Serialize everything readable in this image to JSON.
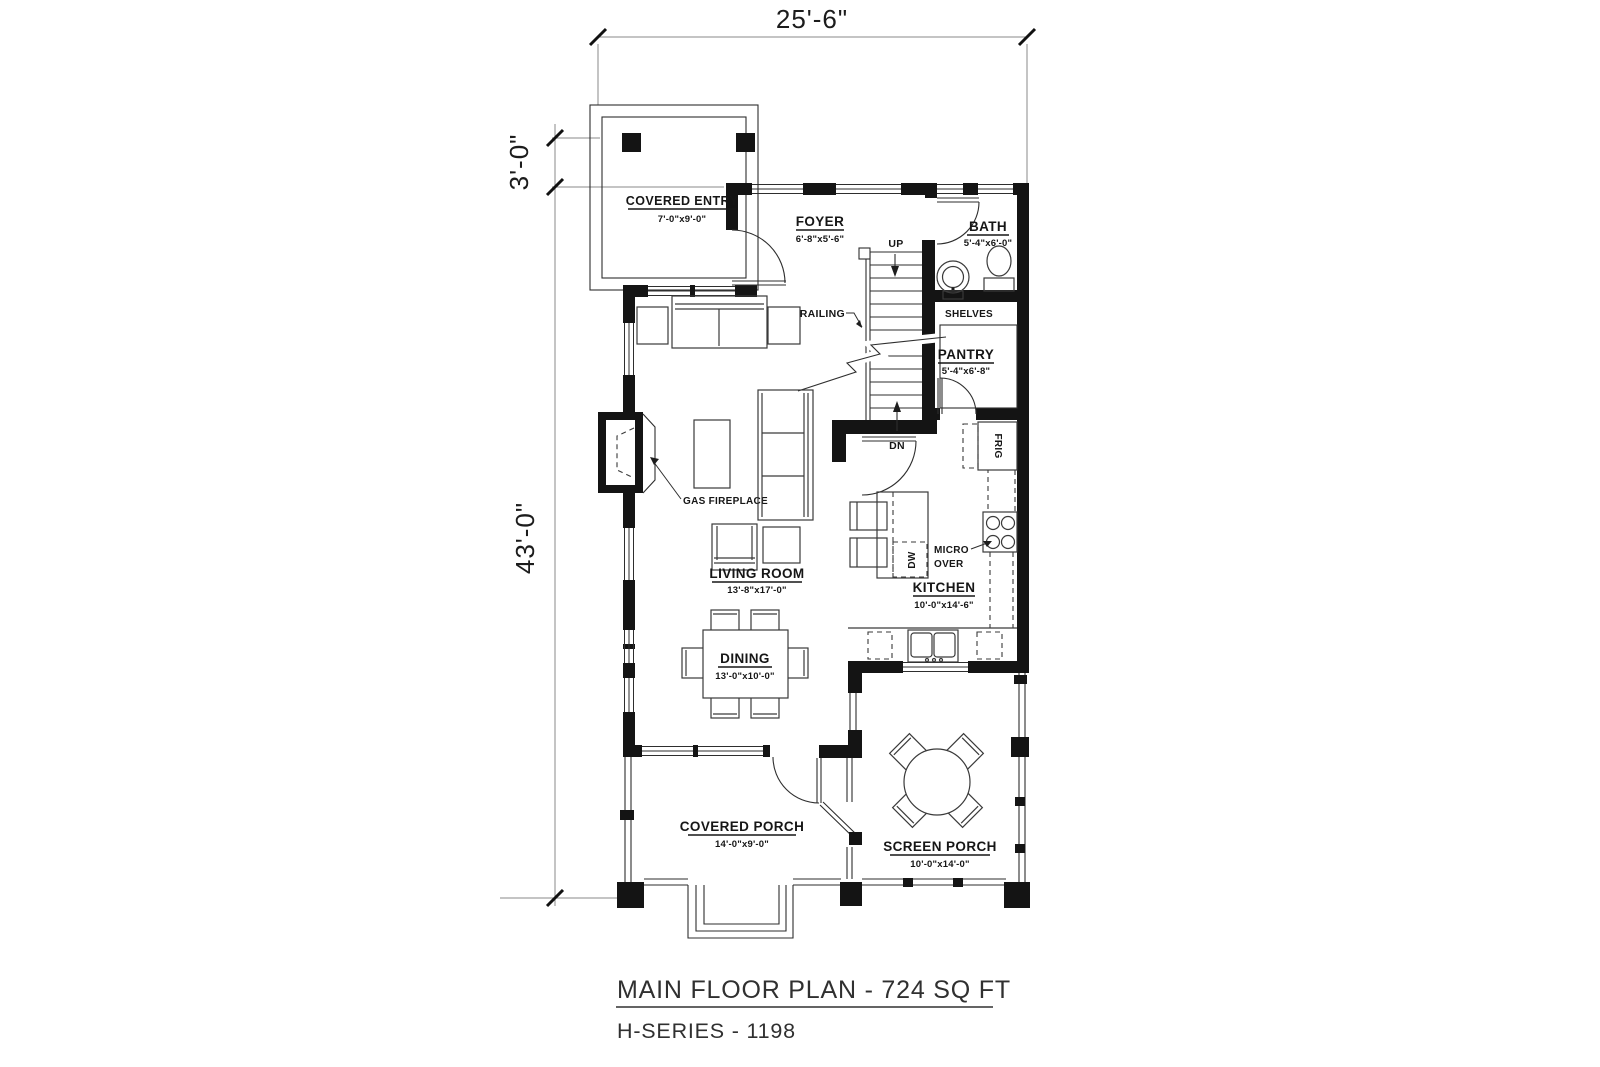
{
  "title": {
    "line1": "MAIN FLOOR PLAN - 724 SQ FT",
    "line2": "H-SERIES - 1198"
  },
  "dimensions": {
    "overall_width": "25'-6\"",
    "entry_depth": "3'-0\"",
    "overall_depth": "43'-0\""
  },
  "rooms": {
    "covered_entry": {
      "name": "COVERED ENTRY",
      "size": "7'-0\"x9'-0\""
    },
    "foyer": {
      "name": "FOYER",
      "size": "6'-8\"x5'-6\""
    },
    "bath": {
      "name": "BATH",
      "size": "5'-4\"x6'-0\""
    },
    "pantry": {
      "name": "PANTRY",
      "size": "5'-4\"x6'-8\""
    },
    "living_room": {
      "name": "LIVING ROOM",
      "size": "13'-8\"x17'-0\""
    },
    "dining": {
      "name": "DINING",
      "size": "13'-0\"x10'-0\""
    },
    "kitchen": {
      "name": "KITCHEN",
      "size": "10'-0\"x14'-6\""
    },
    "covered_porch": {
      "name": "COVERED PORCH",
      "size": "14'-0\"x9'-0\""
    },
    "screen_porch": {
      "name": "SCREEN PORCH",
      "size": "10'-0\"x14'-0\""
    }
  },
  "annotations": {
    "up": "UP",
    "dn": "DN",
    "railing": "RAILING",
    "shelves": "SHELVES",
    "gas_fireplace": "GAS FIREPLACE",
    "frig": "FRIG",
    "dw": "DW",
    "micro": "MICRO",
    "over": "OVER"
  },
  "colors": {
    "wall": "#141414",
    "line": "#2e2e2e",
    "dimension": "#8a8a8a",
    "background": "#ffffff"
  }
}
